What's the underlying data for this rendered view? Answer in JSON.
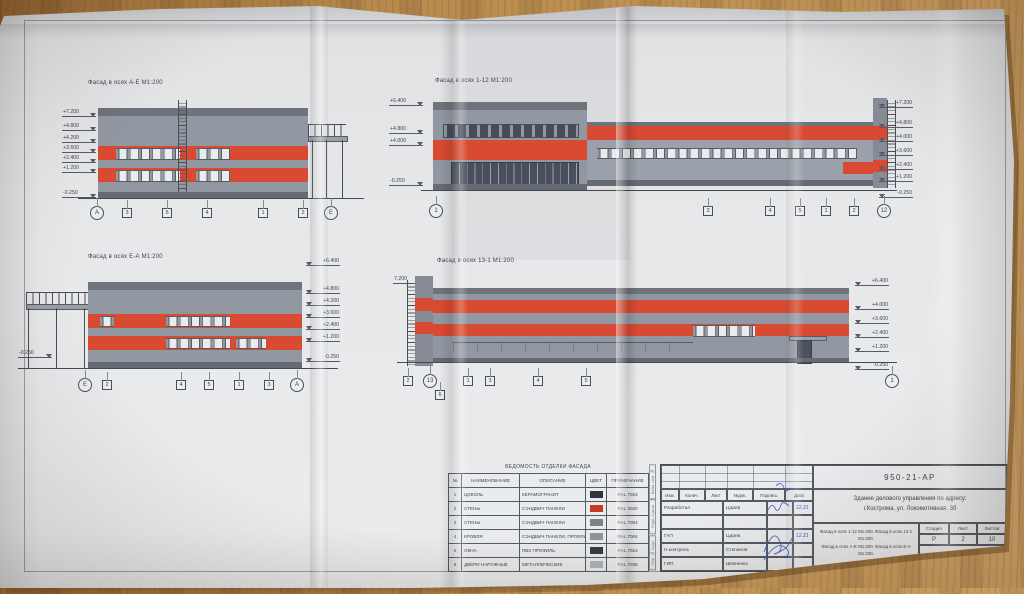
{
  "facades": [
    {
      "label": "Фасад в осях А-Е М1:200",
      "elev_left": [
        "+7.200",
        "+4.800",
        "+4.200",
        "+3.600",
        "+2.400",
        "+1.200",
        "-0.250"
      ],
      "axes": [
        "А",
        "3",
        "5",
        "4",
        "1",
        "2",
        "Е"
      ]
    },
    {
      "label": "Фасад в осях 1-12 М1:200",
      "elev_left": [
        "+6.400",
        "+4.800",
        "+4.000",
        "-0.250"
      ],
      "elev_right": [
        "+7.200",
        "+4.800",
        "+4.000",
        "+3.600",
        "+2.400",
        "+1.200",
        "-0.250"
      ],
      "axes": [
        "1",
        "3",
        "4",
        "5",
        "1",
        "2",
        "12"
      ]
    },
    {
      "label": "Фасад в осях Е-А М1:200",
      "elev_left": [
        "-0.250"
      ],
      "elev_right": [
        "+6.400",
        "+4.800",
        "+4.200",
        "+3.600",
        "+2.400",
        "+1.200",
        "-0.250"
      ],
      "axes": [
        "Е",
        "2",
        "4",
        "5",
        "1",
        "3",
        "А"
      ]
    },
    {
      "label": "Фасад в осях 13-1 М1:200",
      "elev_left": [
        "7.200"
      ],
      "elev_right": [
        "+6.400",
        "+4.000",
        "+3.600",
        "+2.400",
        "+1.200",
        "-0.250"
      ],
      "axes": [
        "2",
        "13",
        "1",
        "3",
        "4",
        "5",
        "6",
        "1"
      ]
    }
  ],
  "legend": {
    "title": "ВЕДОМОСТЬ ОТДЕЛКИ ФАСАДА",
    "cols": [
      "№",
      "НАИМЕНОВАНИЕ",
      "ОПИСАНИЕ",
      "ЦВЕТ",
      "ПРИМЕЧАНИЕ"
    ],
    "rows": [
      {
        "num": "1",
        "name": "ЦОКОЛЬ",
        "desc": "КЕРАМОГРАНИТ",
        "color": "#30343c",
        "note": "RAL 7024"
      },
      {
        "num": "2",
        "name": "СТЕНЫ",
        "desc": "СЭНДВИЧ ПАНЕЛИ",
        "color": "#c23b27",
        "note": "RAL 3020"
      },
      {
        "num": "3",
        "name": "СТЕНЫ",
        "desc": "СЭНДВИЧ ПАНЕЛИ",
        "color": "#7d828b",
        "note": "RAL 7004"
      },
      {
        "num": "4",
        "name": "КРОВЛЯ",
        "desc": "СЭНДВИЧ ПАНЕЛИ, ПРОФЛИСТ",
        "color": "#8f949c",
        "note": "RAL 7004"
      },
      {
        "num": "5",
        "name": "ОКНА",
        "desc": "ПВХ ПРОФИЛЬ",
        "color": "#363c49",
        "note": "RAL 7024"
      },
      {
        "num": "6",
        "name": "ДВЕРИ НАРУЖНЫЕ",
        "desc": "МЕТАЛЛИЧЕСКИЕ",
        "color": "#b0b4ba",
        "note": "RAL 7035"
      }
    ]
  },
  "titleblock": {
    "doc_number": "950-21-АР",
    "project_line1": "Здание делового управления по адресу:",
    "project_line2": "г.Кострома, ул. Локомотивная, 3б",
    "cols": [
      "Изм.",
      "Колич.",
      "Лист",
      "№док.",
      "Подпись",
      "Дата"
    ],
    "roles": [
      {
        "role": "Разработал",
        "name": "Царев",
        "date": "12.21"
      },
      {
        "role": "",
        "name": "",
        "date": ""
      },
      {
        "role": "ГАП",
        "name": "Царев",
        "date": "12.21"
      },
      {
        "role": "Н.контроль",
        "name": "Степанов",
        "date": ""
      },
      {
        "role": "ГИП",
        "name": "Шевченко",
        "date": ""
      }
    ],
    "stage_label": "Стадия",
    "sheet_label": "Лист",
    "sheets_label": "Листов",
    "stage": "Р",
    "sheet": "2",
    "sheets": "10",
    "sheet_title_line1": "Фасад в осях 1-12 М1:200. Фасад в осях 13-1 М1:200.",
    "sheet_title_line2": "Фасад в осях А-Е М1:200. Фасад в осях Е-А М1:200.",
    "company": "ООО \"БЭСТ\""
  },
  "side_labels": [
    "Взам. инв. №",
    "Подп. и дата",
    "Инв. № подл."
  ],
  "colors": {
    "facade_red": "#d84a31",
    "wall_gray": "#9298a2",
    "paper": "#e6e7e9",
    "signature_blue": "#2e4fd0"
  }
}
